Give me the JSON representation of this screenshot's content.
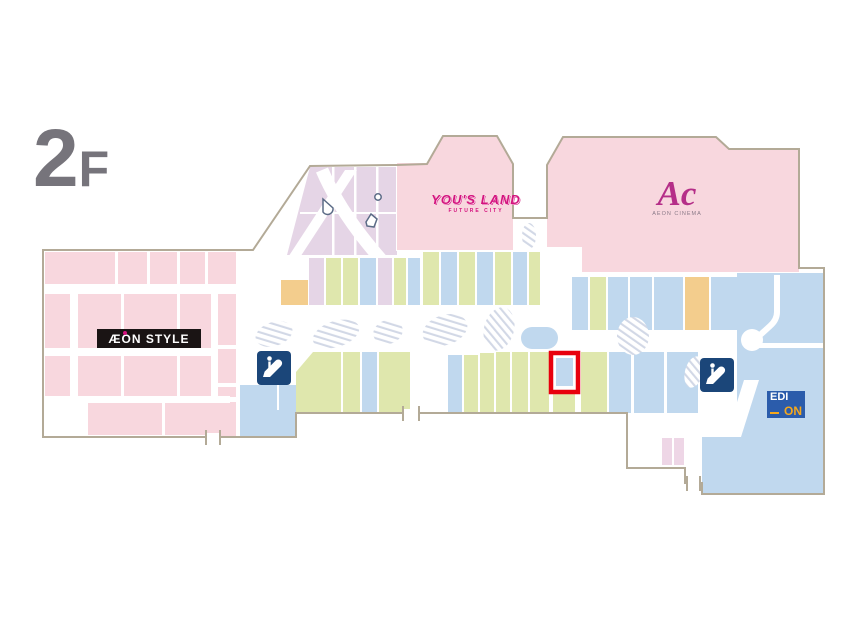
{
  "floor": {
    "label_big": "2",
    "label_small": "F"
  },
  "stores": {
    "aeon_style": {
      "label": "ÆON STYLE"
    },
    "yous_land": {
      "label": "YOU'S LAND",
      "sublabel": "FUTURE CITY"
    },
    "aeon_cinema": {
      "label": "Ac",
      "sublabel": "AEON CINEMA"
    },
    "edion": {
      "label_line1": "EDI",
      "label_line2": "ON"
    }
  },
  "icons": {
    "escalator_left": "escalator",
    "escalator_right": "escalator",
    "elevator_markers": "elevator"
  },
  "palette": {
    "pink": "#f8d7de",
    "pink_light": "#eed6e6",
    "lavender": "#e5d5e6",
    "green": "#dfe7ad",
    "blue": "#c0d8ee",
    "orange": "#f3cd8d",
    "navy": "#1b4679",
    "edion_blue": "#2b5cab",
    "edion_orange": "#f6a81c",
    "magenta": "#d4137e",
    "cinema_magenta": "#b52e88",
    "cinema_sub": "#8a7a88",
    "red": "#e8000d",
    "outline": "#b3aa97",
    "hatch": "#d2d8e6",
    "label_gray": "#76747b",
    "logo_black": "#1a1414"
  }
}
